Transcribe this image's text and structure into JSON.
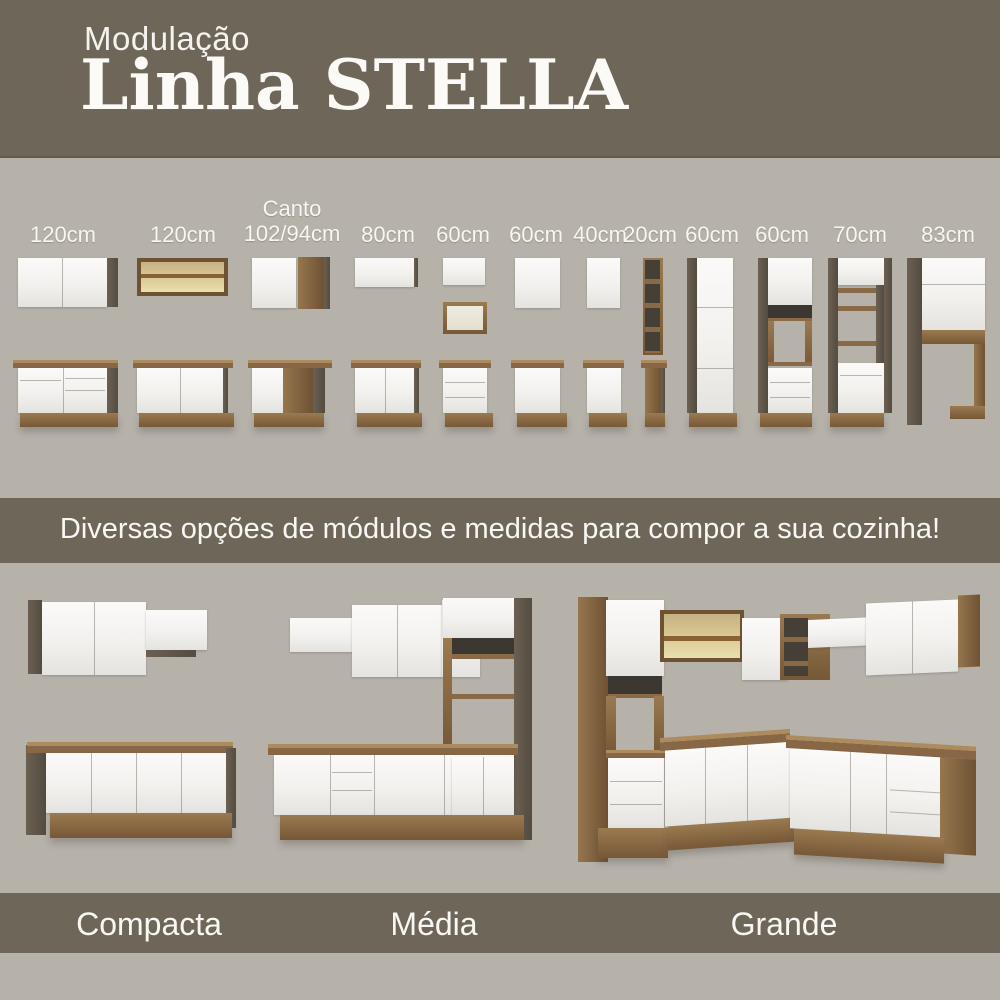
{
  "header": {
    "kicker": "Modulação",
    "title": "Linha STELLA"
  },
  "modules_row": {
    "items": [
      {
        "size": "120cm"
      },
      {
        "size": "120cm"
      },
      {
        "size_top": "Canto",
        "size": "102/94cm"
      },
      {
        "size": "80cm"
      },
      {
        "size": "60cm"
      },
      {
        "size": "60cm"
      },
      {
        "size": "40cm"
      },
      {
        "size": "20cm"
      },
      {
        "size": "60cm"
      },
      {
        "size": "60cm"
      },
      {
        "size": "70cm"
      },
      {
        "size": "83cm"
      }
    ]
  },
  "banner": {
    "text": "Diversas opções de módulos e medidas para compor a sua cozinha!"
  },
  "kitchens": {
    "items": [
      {
        "name": "Compacta"
      },
      {
        "name": "Média"
      },
      {
        "name": "Grande"
      }
    ]
  },
  "colors": {
    "band_olive": "#6e6759",
    "section_background": "#b6b2aa",
    "cabinet_white": "#f5f4f1",
    "wood": "#8a6a46",
    "dark_side_panel": "#554c41",
    "glass_amber": "#d8c691",
    "label_text": "#f7f6f2"
  }
}
